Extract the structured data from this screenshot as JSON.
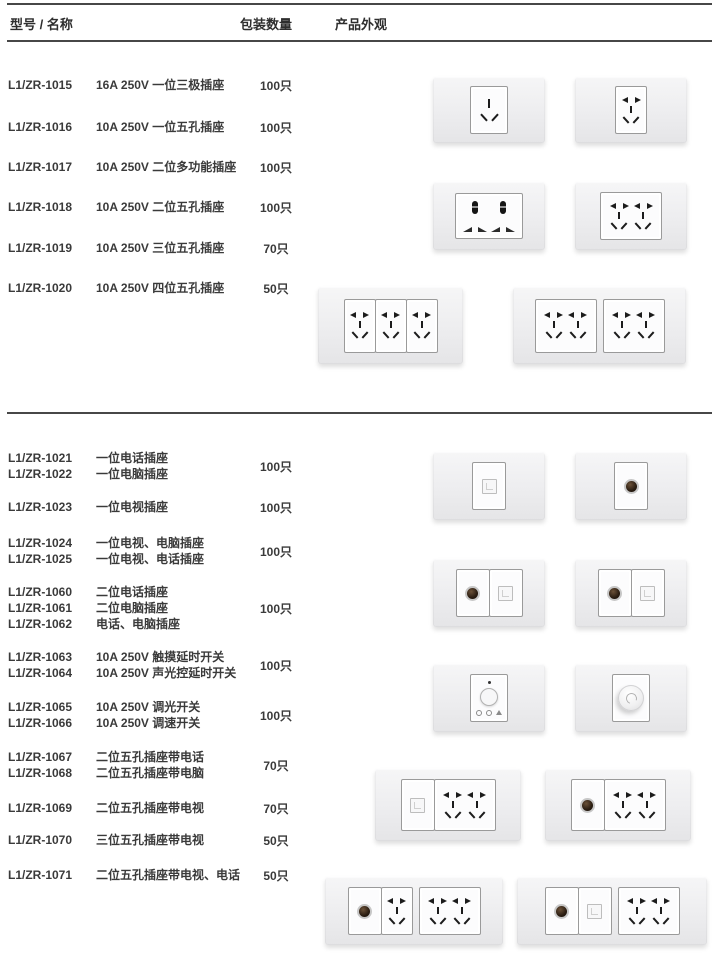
{
  "header": {
    "col_model_name": "型号 / 名称",
    "col_qty": "包装数量",
    "col_appearance": "产品外观"
  },
  "sections": [
    {
      "rows": [
        {
          "models": [
            "L1/ZR-1015"
          ],
          "names": [
            "16A 250V 一位三极插座"
          ],
          "qty": "100只"
        },
        {
          "models": [
            "L1/ZR-1016"
          ],
          "names": [
            "10A 250V 一位五孔插座"
          ],
          "qty": "100只"
        },
        {
          "models": [
            "L1/ZR-1017"
          ],
          "names": [
            "10A 250V 二位多功能插座"
          ],
          "qty": "100只"
        },
        {
          "models": [
            "L1/ZR-1018"
          ],
          "names": [
            "10A 250V 二位五孔插座"
          ],
          "qty": "100只"
        },
        {
          "models": [
            "L1/ZR-1019"
          ],
          "names": [
            "10A 250V 三位五孔插座"
          ],
          "qty": "70只"
        },
        {
          "models": [
            "L1/ZR-1020"
          ],
          "names": [
            "10A 250V 四位五孔插座"
          ],
          "qty": "50只"
        }
      ]
    },
    {
      "rows": [
        {
          "models": [
            "L1/ZR-1021",
            "L1/ZR-1022"
          ],
          "names": [
            "一位电话插座",
            "一位电脑插座"
          ],
          "qty": "100只"
        },
        {
          "models": [
            "L1/ZR-1023"
          ],
          "names": [
            "一位电视插座"
          ],
          "qty": "100只"
        },
        {
          "models": [
            "L1/ZR-1024",
            "L1/ZR-1025"
          ],
          "names": [
            "一位电视、电脑插座",
            "一位电视、电话插座"
          ],
          "qty": "100只"
        },
        {
          "models": [
            "L1/ZR-1060",
            "L1/ZR-1061",
            "L1/ZR-1062"
          ],
          "names": [
            "二位电话插座",
            "二位电脑插座",
            "电话、电脑插座"
          ],
          "qty": "100只"
        },
        {
          "models": [
            "L1/ZR-1063",
            "L1/ZR-1064"
          ],
          "names": [
            "10A 250V 触摸延时开关",
            "10A 250V 声光控延时开关"
          ],
          "qty": "100只"
        },
        {
          "models": [
            "L1/ZR-1065",
            "L1/ZR-1066"
          ],
          "names": [
            "10A 250V 调光开关",
            "10A 250V 调速开关"
          ],
          "qty": "100只"
        },
        {
          "models": [
            "L1/ZR-1067",
            "L1/ZR-1068"
          ],
          "names": [
            "二位五孔插座带电话",
            "二位五孔插座带电脑"
          ],
          "qty": "70只"
        },
        {
          "models": [
            "L1/ZR-1069"
          ],
          "names": [
            "二位五孔插座带电视"
          ],
          "qty": "70只"
        },
        {
          "models": [
            "L1/ZR-1070"
          ],
          "names": [
            "三位五孔插座带电视"
          ],
          "qty": "50只"
        },
        {
          "models": [
            "L1/ZR-1071"
          ],
          "names": [
            "二位五孔插座带电视、电话"
          ],
          "qty": "50只"
        }
      ]
    }
  ],
  "plates": [
    {
      "name": "socket-3pin-1gang",
      "groups": [
        [
          "socket3"
        ]
      ]
    },
    {
      "name": "socket-5hole-1gang",
      "groups": [
        [
          "five1"
        ]
      ]
    },
    {
      "name": "socket-multi-2gang",
      "groups": [
        [
          "multi2"
        ]
      ]
    },
    {
      "name": "socket-5hole-2gang",
      "groups": [
        [
          "five2"
        ]
      ]
    },
    {
      "name": "socket-5hole-3gang",
      "groups": [
        [
          "five1",
          "five1",
          "five1"
        ]
      ]
    },
    {
      "name": "socket-5hole-4gang",
      "groups": [
        [
          "five2"
        ],
        [
          "five2"
        ]
      ]
    },
    {
      "name": "socket-phone-1gang",
      "groups": [
        [
          "rj"
        ]
      ]
    },
    {
      "name": "socket-tv-1gang",
      "groups": [
        [
          "tv"
        ]
      ]
    },
    {
      "name": "socket-tv-data-2gang-a",
      "groups": [
        [
          "tv",
          "rj"
        ]
      ]
    },
    {
      "name": "socket-tv-data-2gang-b",
      "groups": [
        [
          "tv",
          "rj"
        ]
      ]
    },
    {
      "name": "switch-touch-delay",
      "groups": [
        [
          "touch"
        ]
      ]
    },
    {
      "name": "switch-dimmer-knob",
      "groups": [
        [
          "dimmer"
        ]
      ]
    },
    {
      "name": "socket-5hole2-with-phone",
      "groups": [
        [
          "rj",
          "five2"
        ]
      ]
    },
    {
      "name": "socket-5hole2-with-tv",
      "groups": [
        [
          "tv",
          "five2"
        ]
      ]
    },
    {
      "name": "socket-5hole3-with-tv",
      "groups": [
        [
          "tv",
          "five1"
        ],
        [
          "five2"
        ]
      ]
    },
    {
      "name": "socket-5hole2-tv-phone",
      "groups": [
        [
          "tv",
          "rj"
        ],
        [
          "five2"
        ]
      ]
    }
  ],
  "colors": {
    "rule": "#474747",
    "text": "#3a3a3a",
    "plate_fill": "#ededef",
    "slot": "#1c1c1c",
    "tv_port": "#2a1d12"
  }
}
